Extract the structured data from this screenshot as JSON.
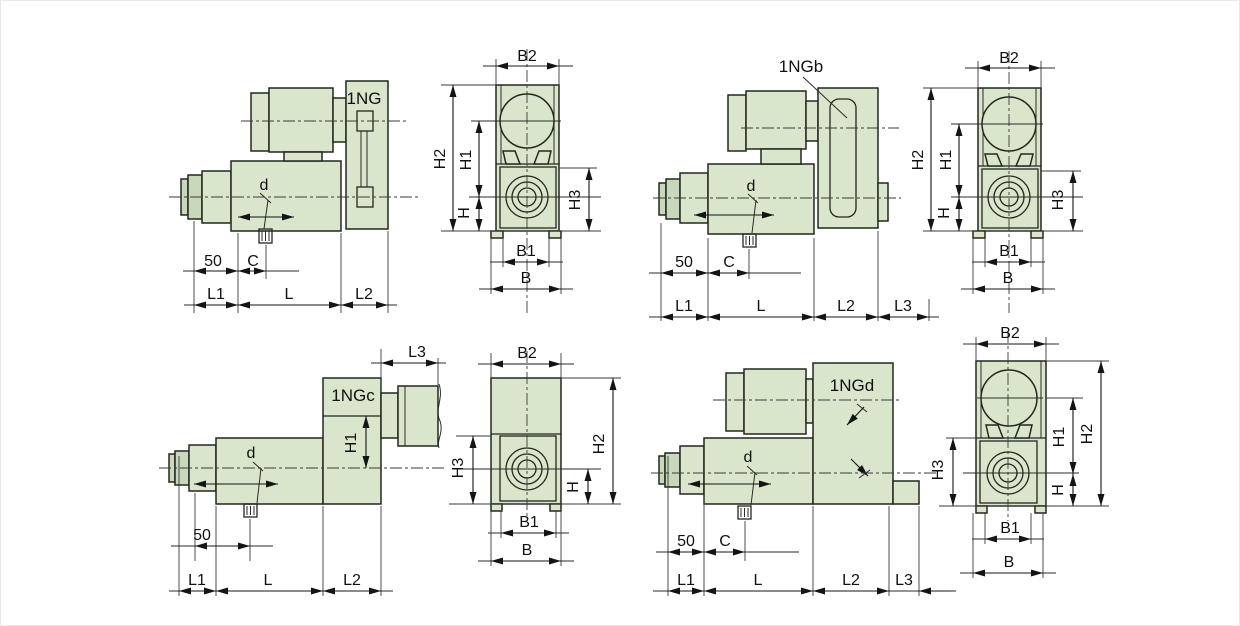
{
  "palette": {
    "background": "#ffffff",
    "part_fill": "#d9e6cb",
    "part_fill_dark": "#c9d8bb",
    "line": "#24261f",
    "dim_line": "#141414"
  },
  "views": {
    "ng_side": {
      "model": "1NG",
      "drain": "d",
      "offset": "50",
      "c": "C",
      "l1": "L1",
      "l": "L",
      "l2": "L2"
    },
    "ng_front": {
      "b2": "B2",
      "h2": "H2",
      "h1": "H1",
      "h": "H",
      "h3": "H3",
      "b1": "B1",
      "b": "B"
    },
    "ngb_side": {
      "model": "1NGb",
      "drain": "d",
      "offset": "50",
      "c": "C",
      "l1": "L1",
      "l": "L",
      "l2": "L2",
      "l3": "L3"
    },
    "ngb_front": {
      "b2": "B2",
      "h2": "H2",
      "h1": "H1",
      "h": "H",
      "h3": "H3",
      "b1": "B1",
      "b": "B"
    },
    "ngc_side": {
      "model": "1NGc",
      "drain": "d",
      "offset": "50",
      "h1": "H1",
      "l1": "L1",
      "l": "L",
      "l2": "L2",
      "l3": "L3"
    },
    "ngc_front": {
      "b2": "B2",
      "h3": "H3",
      "h2": "H2",
      "h": "H",
      "b1": "B1",
      "b": "B"
    },
    "ngd_side": {
      "model": "1NGd",
      "drain": "d",
      "offset": "50",
      "c": "C",
      "l1": "L1",
      "l": "L",
      "l2": "L2",
      "l3": "L3"
    },
    "ngd_front": {
      "b2": "B2",
      "h3": "H3",
      "h1": "H1",
      "h2": "H2",
      "h": "H",
      "b1": "B1",
      "b": "B"
    }
  }
}
